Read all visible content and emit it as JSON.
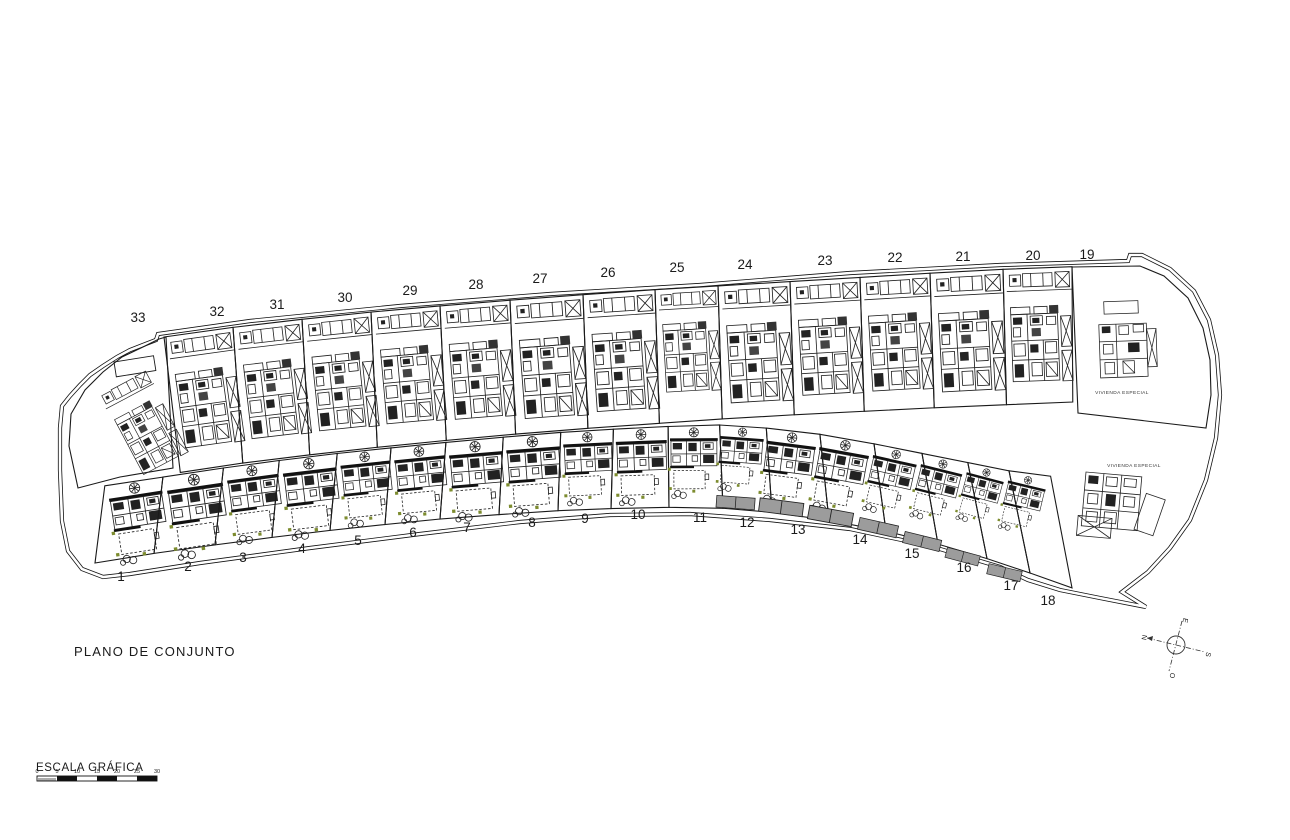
{
  "page": {
    "title": "PLANO DE CONJUNTO"
  },
  "scale_bar": {
    "label": "ESCALA GRÁFICA",
    "ticks": [
      "0",
      "5",
      "10",
      "15",
      "20",
      "25",
      "30"
    ]
  },
  "compass": {
    "north": "N",
    "south": "S",
    "east": "E",
    "west": "O"
  },
  "special_areas": [
    {
      "label": "VIVIENDA ESPECIAL"
    },
    {
      "label": "VIVIENDA ESPECIAL"
    }
  ],
  "upper_plots": [
    {
      "num": "33",
      "x": 138,
      "y": 322
    },
    {
      "num": "32",
      "x": 217,
      "y": 316
    },
    {
      "num": "31",
      "x": 277,
      "y": 309
    },
    {
      "num": "30",
      "x": 345,
      "y": 302
    },
    {
      "num": "29",
      "x": 410,
      "y": 295
    },
    {
      "num": "28",
      "x": 476,
      "y": 289
    },
    {
      "num": "27",
      "x": 540,
      "y": 283
    },
    {
      "num": "26",
      "x": 608,
      "y": 277
    },
    {
      "num": "25",
      "x": 677,
      "y": 272
    },
    {
      "num": "24",
      "x": 745,
      "y": 269
    },
    {
      "num": "23",
      "x": 825,
      "y": 265
    },
    {
      "num": "22",
      "x": 895,
      "y": 262
    },
    {
      "num": "21",
      "x": 963,
      "y": 261
    },
    {
      "num": "20",
      "x": 1033,
      "y": 260
    },
    {
      "num": "19",
      "x": 1087,
      "y": 259
    }
  ],
  "lower_plots": [
    {
      "num": "1",
      "x": 121,
      "y": 581
    },
    {
      "num": "2",
      "x": 188,
      "y": 571
    },
    {
      "num": "3",
      "x": 243,
      "y": 562
    },
    {
      "num": "4",
      "x": 302,
      "y": 553
    },
    {
      "num": "5",
      "x": 358,
      "y": 545
    },
    {
      "num": "6",
      "x": 413,
      "y": 537
    },
    {
      "num": "7",
      "x": 467,
      "y": 532
    },
    {
      "num": "8",
      "x": 532,
      "y": 527
    },
    {
      "num": "9",
      "x": 585,
      "y": 523
    },
    {
      "num": "10",
      "x": 638,
      "y": 519
    },
    {
      "num": "11",
      "x": 700,
      "y": 522
    },
    {
      "num": "12",
      "x": 747,
      "y": 527
    },
    {
      "num": "13",
      "x": 798,
      "y": 534
    },
    {
      "num": "14",
      "x": 860,
      "y": 544
    },
    {
      "num": "15",
      "x": 912,
      "y": 558
    },
    {
      "num": "16",
      "x": 964,
      "y": 572
    },
    {
      "num": "17",
      "x": 1011,
      "y": 590
    },
    {
      "num": "18",
      "x": 1048,
      "y": 605
    }
  ],
  "colors": {
    "line": "#1a1a1a",
    "pad_gray": "#9c9c9c",
    "accent_green": "#7d8c2f"
  }
}
